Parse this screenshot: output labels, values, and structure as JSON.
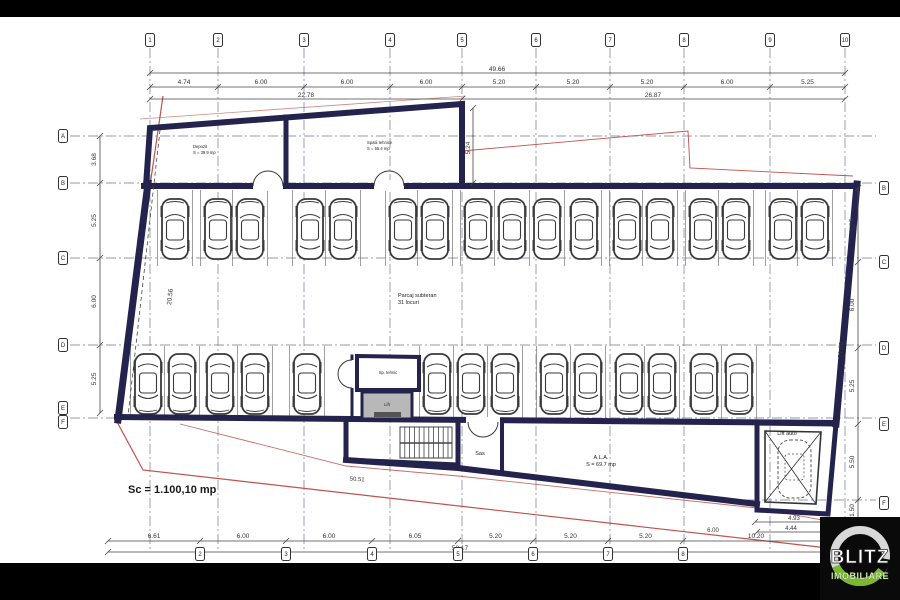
{
  "plan": {
    "rooms": {
      "depozit": {
        "name": "Depozit",
        "area": "S = 39.9 mp"
      },
      "spatii_tehnice": {
        "name": "Spatii tehnice",
        "area": "S = 55.4 mp"
      },
      "parcaj": {
        "name": "Parcaj subteran",
        "capacity": "31 locuri"
      },
      "sp_tehnic": {
        "name": "Sp. tehnic"
      },
      "lift": {
        "name": "Lift"
      },
      "sas": {
        "name": "Sas"
      },
      "ala": {
        "name": "A.L.A.",
        "area": "S = 69.7 mp"
      },
      "lift_auto": {
        "name": "Lift auto"
      }
    },
    "scale_note": "Sc = 1.100,10 mp",
    "dimensions": {
      "top_total": "49.66",
      "top_segments": [
        "4.74",
        "6.00",
        "6.00",
        "6.00",
        "5.20",
        "5.20",
        "5.20",
        "6.00",
        "5.25"
      ],
      "top_sub_left": "22.78",
      "top_sub_right": "26.87",
      "bottom_segments": [
        "6.61",
        "6.00",
        "6.00",
        "6.05",
        "5.20",
        "5.20",
        "5.20",
        "10.20"
      ],
      "bottom_total": "50.17",
      "left_segments": [
        "3.68",
        "5.25",
        "6.00",
        "5.25"
      ],
      "left_wall_length": "20.56",
      "right_segments": [
        "5.25",
        "6.00",
        "5.25",
        "5.50",
        "1.50"
      ],
      "right_wall_length": "21.60",
      "rooms_depth": "5.24",
      "lift_auto_outer": "4.93",
      "lift_auto_inner": "4.44",
      "slope_length": "50.51",
      "ramp_width": "6.00"
    },
    "grid": {
      "top_bubbles": [
        "1",
        "2",
        "3",
        "4",
        "5",
        "6",
        "7",
        "8",
        "9",
        "10"
      ],
      "bottom_bubbles": [
        "2",
        "3",
        "4",
        "5",
        "6",
        "7",
        "8",
        "9"
      ],
      "left_bubbles": [
        "A",
        "B",
        "C",
        "D",
        "E",
        "F"
      ],
      "right_bubbles": [
        "B",
        "C",
        "D",
        "E",
        "F"
      ]
    }
  },
  "logo": {
    "line1": "BLITZ",
    "line2": "IMOBILIARE"
  },
  "colors": {
    "wall": "#23234d",
    "grid_line": "#5a5a8c",
    "boundary_red": "#c0524a",
    "dim_line": "#444444",
    "lift_fill": "#b8b8b8",
    "logo_bg": "#0a0a0a",
    "logo_ring": "#d8d8d8",
    "logo_green": "#7cb82f"
  }
}
